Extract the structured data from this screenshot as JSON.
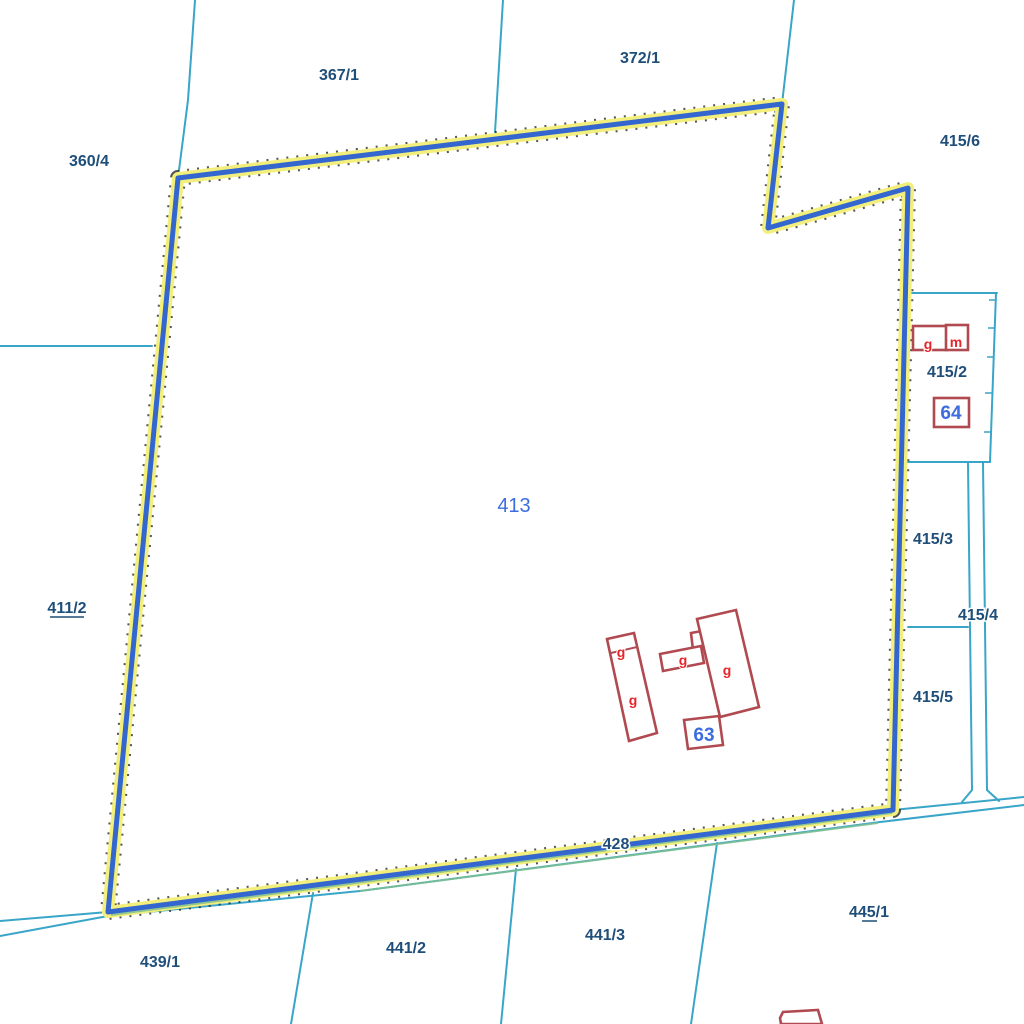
{
  "map": {
    "selected_parcel": "413",
    "colors": {
      "background": "#ffffff",
      "parcel_line": "#39A5C8",
      "highlight_halo": "#F3EF7D",
      "highlight_stroke": "#3366CF",
      "building_outline": "#B04A50",
      "building_use_letter": "#E62429",
      "parcel_label": "#1E4E79",
      "selected_label": "#3C6CE0"
    },
    "labels": {
      "p360_4": "360/4",
      "p367_1": "367/1",
      "p372_1": "372/1",
      "p415_6": "415/6",
      "p415_2": "415/2",
      "p415_3": "415/3",
      "p415_4": "415/4",
      "p415_5": "415/5",
      "p411_2": "411/2",
      "p413": "413",
      "p428": "428",
      "p439_1": "439/1",
      "p441_2": "441/2",
      "p441_3": "441/3",
      "p445_1": "445/1",
      "house_63": "63",
      "house_64": "64",
      "use_g_1": "g",
      "use_g_2": "g",
      "use_g_3": "g",
      "use_g_4": "g",
      "use_g_5": "g",
      "use_m_1": "m"
    }
  }
}
